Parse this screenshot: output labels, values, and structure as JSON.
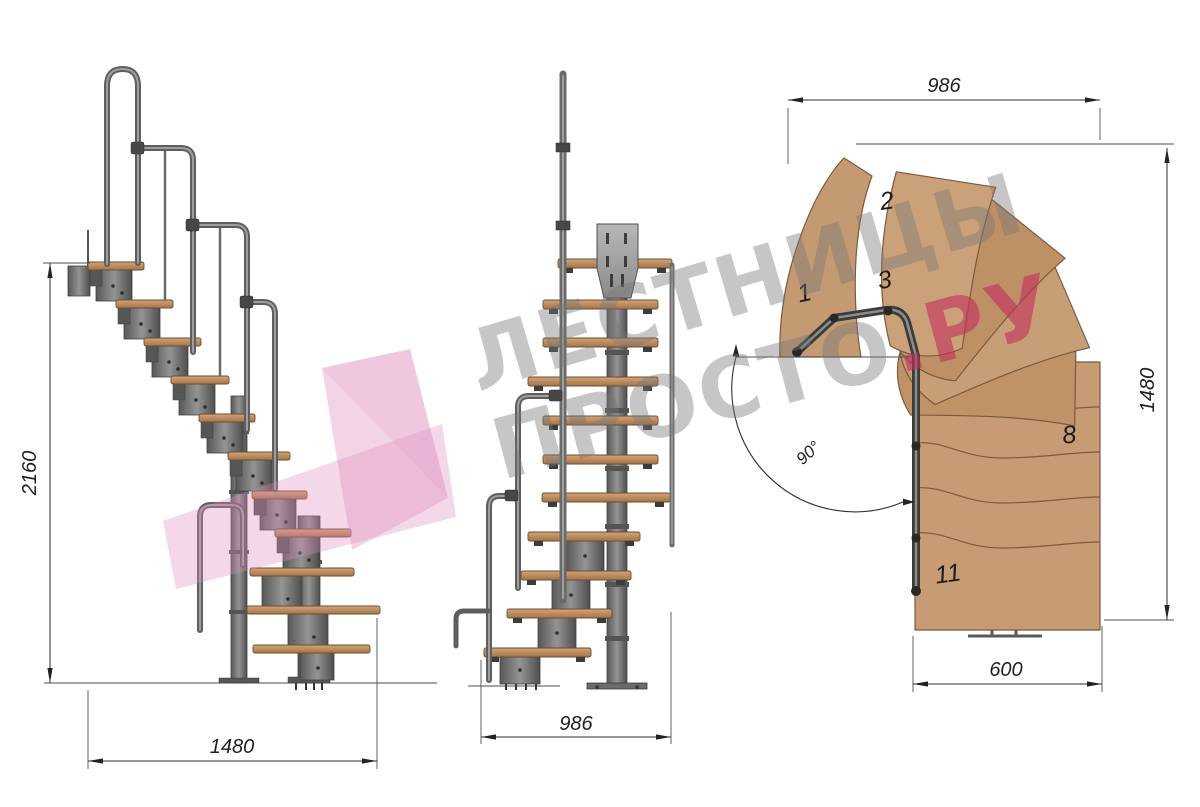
{
  "watermark": {
    "line1": "ЛЕСТНИЦЫ",
    "line2": "ПРОСТО",
    "accent": ".РУ"
  },
  "dimensions": {
    "side_view": {
      "height": "2160",
      "length": "1480"
    },
    "front_view": {
      "width": "986"
    },
    "plan_view": {
      "width": "986",
      "depth": "1480",
      "exit_width": "600",
      "turn_angle": "90°"
    }
  },
  "plan_view": {
    "tread_labels": [
      "1",
      "2",
      "3",
      "8",
      "11"
    ]
  },
  "colors": {
    "background": "#ffffff",
    "steel": "#737373",
    "steel_dark": "#414141",
    "wood_side": "#b5865a",
    "wood_plan": "#c79c74",
    "wood_edge": "#7d5a3a",
    "dimension_line": "#2e2e2e",
    "watermark_gray": "#777777",
    "watermark_pink": "#c22e5e",
    "watermark_arrow_pink": "#e08cbe"
  }
}
